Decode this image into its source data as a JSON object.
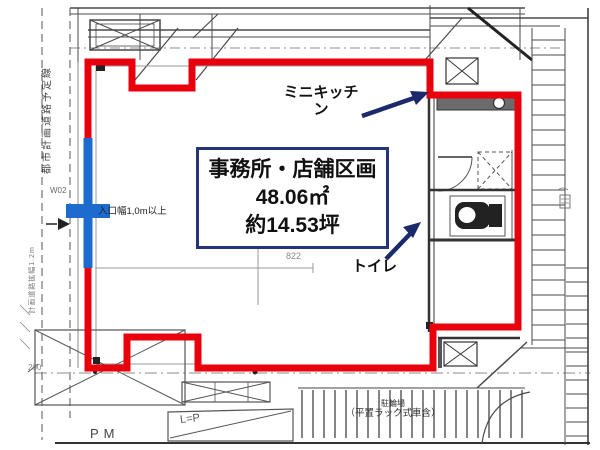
{
  "unit": {
    "name": "事務所・店舗区画",
    "area_m2": "48.06㎡",
    "area_tsubo": "約14.53坪"
  },
  "annotations": {
    "mini_kitchen": "ミニキッチン",
    "toilet": "トイレ",
    "entrance_width": "入口幅1,0m以上",
    "city_planning_road": "都市計画道路予定線",
    "road_widening": "計画道路拡幅1.2m",
    "grid_mark": "W02",
    "dim_822": "822",
    "dim_200": "200",
    "parking_pm": "PM",
    "lp_mark": "L=P",
    "bicycle_parking_line1": "駐輪場",
    "bicycle_parking_line2": "（平置ラック式車含）"
  },
  "colors": {
    "unit_outline_red": "#e8000d",
    "entrance_blue": "#1e6bd0",
    "label_border_navy": "#26357a",
    "arrow_navy": "#1b2a6b"
  }
}
